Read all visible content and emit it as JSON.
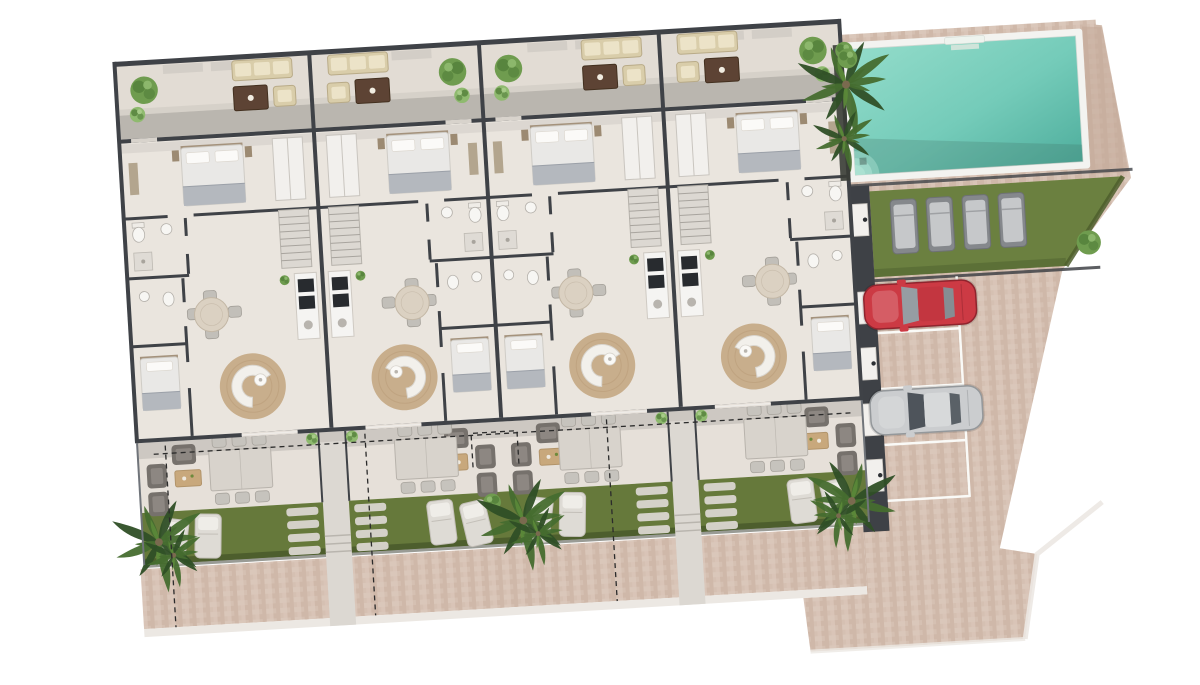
{
  "scene": {
    "name": "Residential development site plan, top-down 3D render",
    "type": "architectural-floor-plan",
    "visible_text": "none"
  },
  "palette": {
    "page_bg": "#ffffff",
    "stone1": "#d5c0b2",
    "stone2": "#c9b1a1",
    "stone3": "#decbbe",
    "stone_dark": "#c3a898",
    "curb": "#ece8e3",
    "wall": "#3f4247",
    "wall_soft": "#55584f",
    "fence": "#70747a",
    "floor": "#eae5de",
    "terrace_floor": "#e2dcd4",
    "cov_terrace": "#e6e0d9",
    "shadow_band": "#b6b1ab",
    "shadow_soft": "#cfc9c2",
    "shadow_room": "#d8d3cd",
    "shadow_cov": "#c7c2bc",
    "grass": "#66793b",
    "grass_dark": "#4d5e2d",
    "lawn": "#6b8040",
    "hedge": "#4e5f2d",
    "pool_rim": "#f3f3f0",
    "pool_light": "#93dcca",
    "pool_deep": "#4fae9d",
    "pool_step": "#aee3d3",
    "jute": "#c8ae8c",
    "jute_ring": "#b89a76",
    "beige": "#d9cdaa",
    "beige_light": "#ece3c8",
    "beige_stroke": "#b9ab88",
    "brown": "#5d4334",
    "brown_dark": "#43301f",
    "wood": "#c8a87c",
    "wood_stroke": "#b2946a",
    "white_furn": "#f2f0ed",
    "furn_stroke": "#c9c5bf",
    "bed_duvet": "#e9e8e6",
    "bed_throw": "#b4b8be",
    "pillow": "#fbfaf8",
    "headboard": "#a4927c",
    "gray_chair": "#c6c3bd",
    "gray_chair_stroke": "#a8a49d",
    "dark_chair": "#76716c",
    "dark_chair_in": "#8d8782",
    "appliance": "#282b2f",
    "stairs": "#dcd8d2",
    "stairs_tread": "#a8a49e",
    "lounger": "#dedbd5",
    "lounger_back": "#efede8",
    "lounger_stroke": "#c3bfb8",
    "lawn_lounger": "#85888c",
    "lawn_lounger_pad": "#c6c8ca",
    "stone_pad": "#dad6d0",
    "palm1": "#2f4f26",
    "palm2": "#466d2f",
    "palm3": "#5b8839",
    "trunk": "#7a6a4f",
    "bush": "#6f9c4f",
    "bush_dark": "#527f3a",
    "bush_light": "#8fba6f",
    "stall_line": "#fafaf7",
    "car_red": "#cc3a44",
    "car_red_stroke": "#8f242d",
    "car_red_roof": "#c33640",
    "car_silver": "#cbcdcf",
    "car_silver_stroke": "#94989b",
    "car_silver_roof": "#d7d9da",
    "glass": "#969da3",
    "glass_dark": "#4e545b",
    "dash": "#2b2b2b",
    "walkway": "#dcd8d2",
    "walkway_step": "#b9b5ae",
    "walkway_porch": "#c8c3bd"
  },
  "building": {
    "units": [
      {
        "id": "unit-1",
        "x": 28,
        "w": 195,
        "mirrored": false,
        "garden_palm": true
      },
      {
        "id": "unit-2",
        "x": 223,
        "w": 170,
        "mirrored": true,
        "garden_palm": false
      },
      {
        "id": "unit-3",
        "x": 393,
        "w": 180,
        "mirrored": false,
        "garden_palm": true
      },
      {
        "id": "unit-4",
        "x": 573,
        "w": 181,
        "mirrored": true,
        "garden_palm": true
      }
    ],
    "walkway_x": [
      223,
      573
    ],
    "unit_features": [
      "rear patio with outdoor sofa, coffee table and armchair",
      "double bedroom with wardrobe",
      "bathroom with shower",
      "staircase",
      "second bathroom",
      "single bedroom",
      "kitchen with appliances",
      "round dining table with four chairs",
      "curved sofa on round jute rug",
      "covered front terrace with six-seat dining table",
      "outdoor lounge corner with three armchairs and wood table",
      "private garden with two sun loungers and stepping stones"
    ]
  },
  "amenities": {
    "pool": {
      "shape": "rectangular",
      "steps": "corner beach entry",
      "palms_beside": 2
    },
    "sunbathing_lawn": {
      "loungers": 4
    },
    "parking": {
      "stalls": 4,
      "cars": [
        {
          "name": "red-car",
          "stall": 1,
          "color": "red"
        },
        {
          "name": "silver-car",
          "stall": 3,
          "color": "silver"
        }
      ],
      "empty_stalls": [
        2,
        4
      ]
    },
    "storerooms": 5,
    "walkways": 2,
    "dashed_boundary_guides": true
  }
}
